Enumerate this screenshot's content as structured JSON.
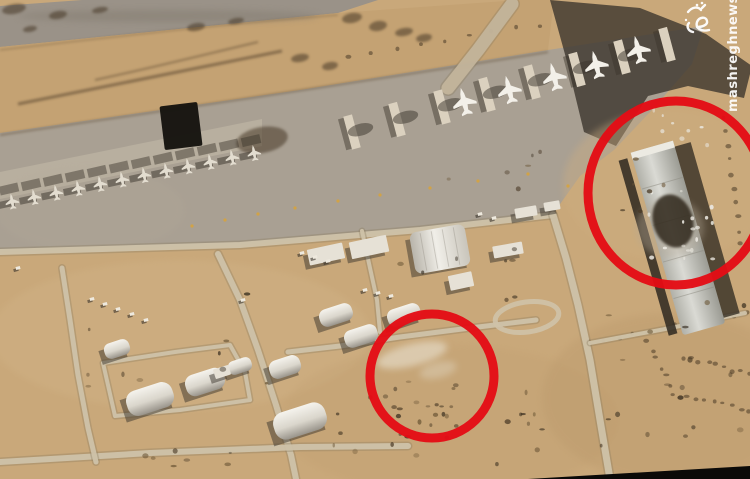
{
  "image": {
    "width": 750,
    "height": 479,
    "description": "Aerial satellite photograph of a desert airbase with parked aircraft; two red circles annotate damage locations"
  },
  "watermark": {
    "url_text": "mashreghnews.ir",
    "logo_text": "مشرق",
    "color": "#ffffff"
  },
  "annotations": {
    "stroke_color": "#e40d15",
    "stroke_width": 9,
    "circles": [
      {
        "name": "small-annotation-circle",
        "cx": 432,
        "cy": 376,
        "rx": 62,
        "ry": 62
      },
      {
        "name": "large-annotation-circle",
        "cx": 676,
        "cy": 193,
        "rx": 88,
        "ry": 92
      }
    ]
  },
  "palette": {
    "sand": "#c9a87a",
    "berm": "#c4a273",
    "runway": "#9a9288",
    "apron": "#a9a093",
    "road": "#cfc2a9",
    "road_edge": "#8a7a5f",
    "shadow": "#3a332b",
    "white_bldg": "#e6e1d6",
    "grey_bldg": "#c6c6c0",
    "dark_bldg": "#15130f",
    "red": "#e40d15",
    "photo_edge": "#0b0a08",
    "jet": "#e3ddd0",
    "transport": "#f3f0e9",
    "debris": "#eae7df",
    "yellow": "#d8a33a"
  },
  "terrain": {
    "polys": [
      {
        "name": "top-runway",
        "fill": "#9a9288",
        "op": 1,
        "pts": [
          [
            0,
            6
          ],
          [
            82,
            0
          ],
          [
            378,
            0
          ],
          [
            338,
            13
          ],
          [
            0,
            47
          ]
        ]
      },
      {
        "name": "berm",
        "fill": "#c4a273",
        "op": 1,
        "pts": [
          [
            0,
            47
          ],
          [
            338,
            13
          ],
          [
            520,
            0
          ],
          [
            554,
            0
          ],
          [
            548,
            50
          ],
          [
            300,
            90
          ],
          [
            0,
            133
          ]
        ]
      },
      {
        "name": "apron",
        "fill": "#a9a093",
        "op": 1,
        "pts": [
          [
            0,
            133
          ],
          [
            300,
            90
          ],
          [
            548,
            50
          ],
          [
            704,
            26
          ],
          [
            692,
            64
          ],
          [
            652,
            110
          ],
          [
            614,
            150
          ],
          [
            580,
            176
          ],
          [
            553,
            214
          ],
          [
            420,
            230
          ],
          [
            240,
            245
          ],
          [
            0,
            252
          ]
        ]
      },
      {
        "name": "fighter-revetment-band",
        "fill": "#b8af9f",
        "op": 1,
        "pts": [
          [
            0,
            172
          ],
          [
            262,
            119
          ],
          [
            262,
            146
          ],
          [
            0,
            199
          ]
        ]
      },
      {
        "name": "cast-shadow",
        "fill": "#3a332b",
        "op": 0.78,
        "pts": [
          [
            550,
            0
          ],
          [
            640,
            8
          ],
          [
            706,
            34
          ],
          [
            752,
            66
          ],
          [
            744,
            98
          ],
          [
            688,
            86
          ],
          [
            648,
            96
          ],
          [
            616,
            146
          ],
          [
            584,
            132
          ],
          [
            566,
            58
          ]
        ]
      },
      {
        "name": "photo-edge-wedge",
        "fill": "#0b0a08",
        "op": 1,
        "pts": [
          [
            528,
            479
          ],
          [
            750,
            466
          ],
          [
            750,
            479
          ]
        ]
      }
    ],
    "tones": [
      {
        "cx": 180,
        "cy": 335,
        "rx": 190,
        "ry": 75,
        "f": "#d3b68a",
        "o": 0.33
      },
      {
        "cx": 450,
        "cy": 420,
        "rx": 170,
        "ry": 75,
        "f": "#c09e70",
        "o": 0.28
      },
      {
        "cx": 672,
        "cy": 398,
        "rx": 130,
        "ry": 85,
        "f": "#b9986a",
        "o": 0.33
      },
      {
        "cx": 668,
        "cy": 185,
        "rx": 105,
        "ry": 75,
        "f": "#cdad80",
        "o": 0.4
      },
      {
        "cx": 90,
        "cy": 210,
        "rx": 95,
        "ry": 42,
        "f": "#b3a998",
        "o": 0.25
      },
      {
        "cx": 168,
        "cy": 16,
        "rx": 150,
        "ry": 6,
        "f": "#837b6f",
        "o": 0.5
      }
    ]
  },
  "marks": {
    "streaks": [
      {
        "d": "M18,104 C100,88 190,70 282,51",
        "w": 3,
        "o": 0.6
      },
      {
        "d": "M95,80 C160,66 215,52 258,42",
        "w": 2,
        "o": 0.5
      },
      {
        "d": "M0,135 C110,118 300,92 548,52",
        "w": 2,
        "o": 0.45
      },
      {
        "d": "M0,50 C120,36 240,22 338,15",
        "w": 1.5,
        "o": 0.35
      }
    ],
    "blobs": [
      [
        14,
        9,
        12,
        5
      ],
      [
        58,
        15,
        9,
        4
      ],
      [
        100,
        10,
        8,
        3
      ],
      [
        30,
        29,
        7,
        3
      ],
      [
        196,
        27,
        9,
        4
      ],
      [
        236,
        21,
        8,
        3
      ],
      [
        352,
        18,
        10,
        5
      ],
      [
        378,
        26,
        9,
        5
      ],
      [
        404,
        32,
        9,
        4
      ],
      [
        424,
        38,
        8,
        4
      ],
      [
        300,
        58,
        9,
        4
      ],
      [
        330,
        66,
        8,
        4
      ],
      [
        262,
        140,
        26,
        13
      ]
    ],
    "dotlines": [
      {
        "from": [
          348,
          57
        ],
        "to": [
          540,
          25
        ],
        "n": 9
      },
      {
        "from": [
          590,
          343
        ],
        "to": [
          748,
          312
        ],
        "n": 12
      },
      {
        "from": [
          647,
          341
        ],
        "to": [
          674,
          394
        ],
        "n": 7
      },
      {
        "from": [
          683,
          357
        ],
        "to": [
          750,
          374
        ],
        "n": 9
      },
      {
        "from": [
          687,
          397
        ],
        "to": [
          750,
          410
        ],
        "n": 8
      },
      {
        "from": [
          722,
          118
        ],
        "to": [
          742,
          245
        ],
        "n": 10
      }
    ]
  },
  "roads": {
    "color": "#cfc2a9",
    "edge": "#8a7a5f",
    "items": [
      {
        "name": "perimeter-road",
        "w": 6,
        "pts": [
          [
            0,
            252
          ],
          [
            240,
            245
          ],
          [
            420,
            230
          ],
          [
            553,
            215
          ]
        ]
      },
      {
        "name": "north-south-road",
        "w": 7,
        "pts": [
          [
            553,
            215
          ],
          [
            566,
            258
          ],
          [
            578,
            305
          ],
          [
            590,
            360
          ],
          [
            600,
            420
          ],
          [
            610,
            479
          ]
        ]
      },
      {
        "name": "diagonal-road",
        "w": 6,
        "pts": [
          [
            218,
            254
          ],
          [
            240,
            300
          ],
          [
            258,
            350
          ],
          [
            276,
            405
          ],
          [
            291,
            455
          ],
          [
            296,
            479
          ]
        ]
      },
      {
        "name": "south-road",
        "w": 6,
        "pts": [
          [
            0,
            462
          ],
          [
            150,
            453
          ],
          [
            300,
            447
          ],
          [
            408,
            446
          ]
        ]
      },
      {
        "name": "west-road",
        "w": 5,
        "pts": [
          [
            62,
            268
          ],
          [
            70,
            320
          ],
          [
            78,
            375
          ],
          [
            88,
            428
          ],
          [
            96,
            462
          ]
        ]
      },
      {
        "name": "mid-road",
        "w": 5,
        "pts": [
          [
            288,
            352
          ],
          [
            340,
            346
          ],
          [
            400,
            337
          ],
          [
            470,
            328
          ],
          [
            536,
            320
          ]
        ]
      },
      {
        "name": "connector-road",
        "w": 4,
        "pts": [
          [
            362,
            231
          ],
          [
            370,
            268
          ],
          [
            377,
            300
          ],
          [
            380,
            332
          ]
        ]
      },
      {
        "name": "compound-road",
        "w": 4,
        "pts": [
          [
            103,
            363
          ],
          [
            175,
            352
          ],
          [
            230,
            345
          ],
          [
            245,
            372
          ],
          [
            250,
            400
          ],
          [
            180,
            410
          ],
          [
            115,
            416
          ],
          [
            103,
            363
          ]
        ]
      },
      {
        "name": "east-road",
        "w": 4,
        "pts": [
          [
            590,
            343
          ],
          [
            660,
            330
          ],
          [
            745,
            313
          ]
        ]
      },
      {
        "name": "runway-link-road",
        "w": 13,
        "light": "#c3b49b",
        "pts": [
          [
            448,
            88
          ],
          [
            478,
            50
          ],
          [
            512,
            4
          ]
        ]
      }
    ],
    "loop": {
      "cx": 527,
      "cy": 317,
      "rx": 32,
      "ry": 15,
      "rot": -8
    }
  },
  "buildings": [
    {
      "name": "dark-hangar",
      "cx": 181,
      "cy": 126,
      "w": 38,
      "h": 44,
      "rot": -7,
      "type": "dark"
    },
    {
      "name": "flat-building",
      "cx": 326,
      "cy": 254,
      "w": 36,
      "h": 16,
      "rot": -12,
      "type": "flat"
    },
    {
      "name": "flat-building",
      "cx": 369,
      "cy": 247,
      "w": 38,
      "h": 17,
      "rot": -12,
      "type": "flat"
    },
    {
      "name": "arched-hangar",
      "cx": 440,
      "cy": 249,
      "w": 56,
      "h": 42,
      "rot": -10,
      "type": "dome"
    },
    {
      "name": "shed",
      "cx": 461,
      "cy": 281,
      "w": 24,
      "h": 15,
      "rot": -12,
      "type": "flat"
    },
    {
      "name": "flat-building",
      "cx": 508,
      "cy": 250,
      "w": 30,
      "h": 12,
      "rot": -10,
      "type": "flat"
    },
    {
      "name": "flat-building",
      "cx": 526,
      "cy": 212,
      "w": 22,
      "h": 10,
      "rot": -10,
      "type": "flat"
    },
    {
      "name": "flat-building",
      "cx": 552,
      "cy": 206,
      "w": 16,
      "h": 9,
      "rot": -10,
      "type": "flat"
    },
    {
      "name": "quonset-hut",
      "cx": 150,
      "cy": 399,
      "w": 48,
      "h": 26,
      "rot": -18,
      "type": "quonset"
    },
    {
      "name": "quonset-hut",
      "cx": 205,
      "cy": 382,
      "w": 40,
      "h": 22,
      "rot": -18,
      "type": "quonset"
    },
    {
      "name": "quonset-hut",
      "cx": 240,
      "cy": 366,
      "w": 24,
      "h": 14,
      "rot": -18,
      "type": "quonset"
    },
    {
      "name": "quonset-hut",
      "cx": 117,
      "cy": 349,
      "w": 26,
      "h": 16,
      "rot": -18,
      "type": "quonset"
    },
    {
      "name": "quonset-hut",
      "cx": 285,
      "cy": 367,
      "w": 32,
      "h": 19,
      "rot": -18,
      "type": "quonset"
    },
    {
      "name": "quonset-hut",
      "cx": 336,
      "cy": 315,
      "w": 34,
      "h": 18,
      "rot": -18,
      "type": "quonset"
    },
    {
      "name": "quonset-hut",
      "cx": 361,
      "cy": 336,
      "w": 34,
      "h": 18,
      "rot": -18,
      "type": "quonset"
    },
    {
      "name": "quonset-hut",
      "cx": 404,
      "cy": 315,
      "w": 34,
      "h": 18,
      "rot": -18,
      "type": "quonset"
    },
    {
      "name": "quonset-hut",
      "cx": 300,
      "cy": 421,
      "w": 54,
      "h": 28,
      "rot": -18,
      "type": "quonset"
    },
    {
      "name": "shed",
      "cx": 222,
      "cy": 372,
      "w": 16,
      "h": 10,
      "rot": -18,
      "type": "flat"
    }
  ],
  "aircraft": {
    "fighter_row": {
      "count": 12,
      "x0": 12,
      "y0": 201,
      "dx": 22,
      "dy": -4.4,
      "rot": -10,
      "scale": 0.85
    },
    "transport_row": {
      "walls": {
        "count": 8,
        "x0": 352,
        "y0": 132,
        "dx": 45,
        "dy": -12.5,
        "rot": -15
      },
      "planes": [
        [
          464,
          101
        ],
        [
          509,
          89
        ],
        [
          554,
          76
        ],
        [
          596,
          64
        ],
        [
          638,
          49
        ]
      ],
      "rot": -14,
      "scale": 1.5
    }
  },
  "vehicles": [
    [
      92,
      299
    ],
    [
      105,
      304
    ],
    [
      118,
      309
    ],
    [
      132,
      314
    ],
    [
      146,
      320
    ],
    [
      302,
      253
    ],
    [
      315,
      257
    ],
    [
      328,
      261
    ],
    [
      365,
      290
    ],
    [
      378,
      293
    ],
    [
      391,
      296
    ],
    [
      480,
      214
    ],
    [
      494,
      218
    ],
    [
      243,
      300
    ],
    [
      18,
      268
    ]
  ],
  "yellow_dots": [
    [
      192,
      226
    ],
    [
      225,
      220
    ],
    [
      258,
      214
    ],
    [
      295,
      208
    ],
    [
      338,
      201
    ],
    [
      380,
      195
    ],
    [
      430,
      188
    ],
    [
      478,
      181
    ],
    [
      528,
      174
    ],
    [
      568,
      186
    ]
  ],
  "damage": {
    "hangar": {
      "cx": 678,
      "cy": 238,
      "w": 44,
      "len": 190,
      "rot": -16
    },
    "trench": {
      "cx": 648,
      "cy": 247,
      "w": 9,
      "len": 182,
      "rot": -16
    },
    "right_shadow": {
      "cx": 707,
      "cy": 230,
      "w": 17,
      "len": 178,
      "rot": -16
    },
    "blast": {
      "cx": 673,
      "cy": 221,
      "rx": 20,
      "ry": 27,
      "rot": -16
    },
    "smoke": {
      "cx": 670,
      "cy": 228,
      "rx": 34,
      "ry": 30
    },
    "smudges": [
      {
        "cx": 412,
        "cy": 355,
        "rx": 36,
        "ry": 11,
        "rot": -14,
        "f": "#e9e2d2",
        "o": 0.6
      },
      {
        "cx": 438,
        "cy": 370,
        "rx": 19,
        "ry": 8,
        "rot": -14,
        "f": "#e2dac8",
        "o": 0.4
      }
    ],
    "debris_regions": [
      {
        "x": 645,
        "y": 110,
        "w": 65,
        "h": 40,
        "n": 8
      },
      {
        "x": 645,
        "y": 188,
        "w": 70,
        "h": 72,
        "n": 18
      }
    ]
  },
  "speckles": [
    {
      "x": 330,
      "y": 385,
      "w": 230,
      "h": 85,
      "n": 24
    },
    {
      "x": 600,
      "y": 300,
      "w": 145,
      "h": 160,
      "n": 18
    },
    {
      "x": 368,
      "y": 248,
      "w": 150,
      "h": 55,
      "n": 8
    },
    {
      "x": 448,
      "y": 140,
      "w": 130,
      "h": 55,
      "n": 6
    },
    {
      "x": 95,
      "y": 430,
      "w": 150,
      "h": 40,
      "n": 7
    },
    {
      "x": 620,
      "y": 150,
      "w": 60,
      "h": 80,
      "n": 6
    },
    {
      "x": 85,
      "y": 290,
      "w": 200,
      "h": 100,
      "n": 10
    },
    {
      "x": 392,
      "y": 380,
      "w": 80,
      "h": 58,
      "n": 14
    }
  ]
}
